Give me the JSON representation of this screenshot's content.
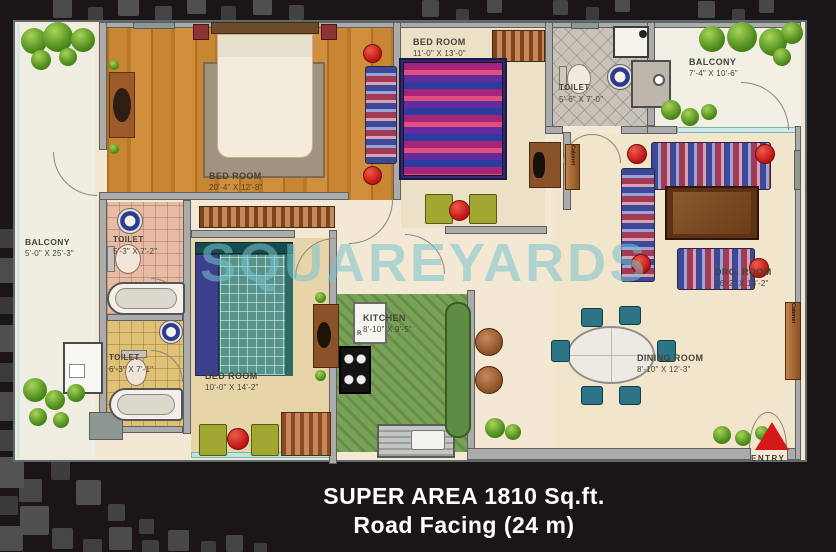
{
  "page": {
    "caption": {
      "line1": "SUPER AREA 1810 Sq.ft.",
      "line2": "Road Facing (24 m)"
    }
  },
  "plan": {
    "watermark": "SQUAREYARDS",
    "entry_label": "ENTRY",
    "cabinet_label": "Cabinet",
    "fridge_label": "R",
    "rooms": {
      "master_bedroom": {
        "name": "BED ROOM",
        "dims": "20'-4\" X 12'-8\""
      },
      "bedroom_2": {
        "name": "BED ROOM",
        "dims": "11'-0\" X 13'-0\""
      },
      "bedroom_3": {
        "name": "BED ROOM",
        "dims": "10'-0\" X 14'-2\""
      },
      "toilet_left_upper": {
        "name": "TOILET",
        "dims": "5'-3\" X 7'-2\""
      },
      "toilet_left_lower": {
        "name": "TOILET",
        "dims": "6'-3\" X 7'-1\""
      },
      "toilet_top": {
        "name": "TOILET",
        "dims": "5'-6\" X 7'-0\""
      },
      "kitchen": {
        "name": "KITCHEN",
        "dims": "8'-10\" X 9'-5\""
      },
      "balcony_left": {
        "name": "BALCONY",
        "dims": "5'-0\" X 25'-3\""
      },
      "balcony_right": {
        "name": "BALCONY",
        "dims": "7'-4\" X 10'-6\""
      },
      "drawing_room": {
        "name": "DRG. ROOM",
        "dims": "16'-2\" X 18'-2\""
      },
      "dining_room": {
        "name": "DINING ROOM",
        "dims": "8'-10\" X 12'-3\""
      }
    },
    "colors": {
      "accent_red": "#cc1f1f",
      "wall_gray": "#ababab",
      "wood_floor": "#c07c2c",
      "watermark_teal": "#7fc4cc",
      "background_dark": "#1c1517"
    }
  }
}
